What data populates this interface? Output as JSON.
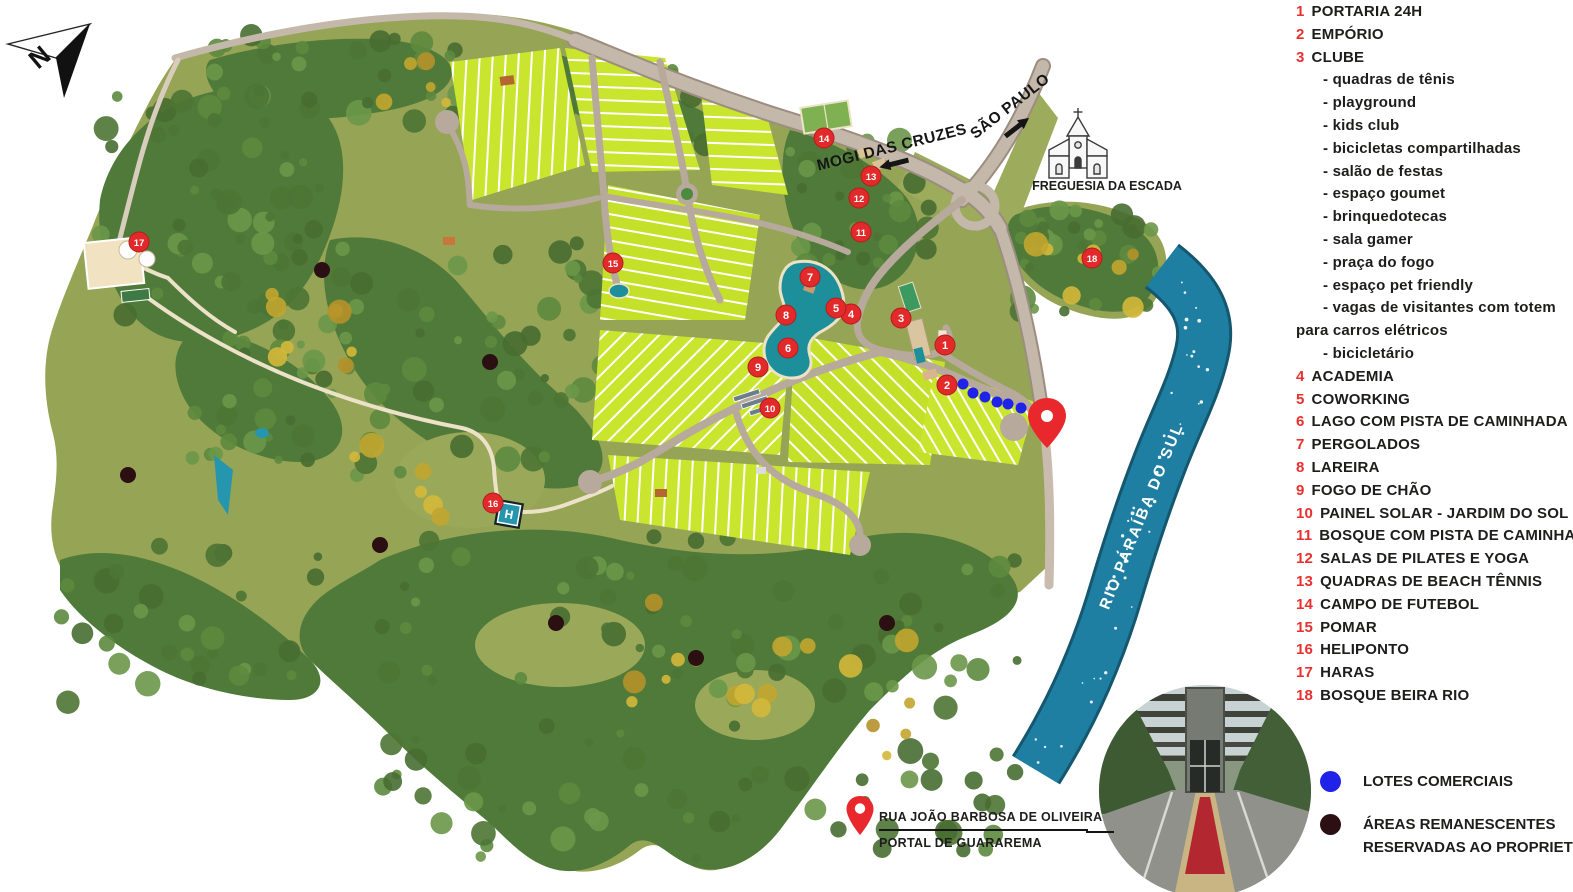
{
  "page": {
    "width": 1573,
    "height": 892,
    "background": "#ffffff"
  },
  "compass": {
    "label": "N"
  },
  "map_labels": {
    "road_west": "MOGI DAS CRUZES",
    "road_east": "SÃO PAULO",
    "church": "FREGUESIA DA ESCADA",
    "river": "RIO PARAÍBA DO SUL",
    "heliport_letter": "H"
  },
  "entrance_label": {
    "line1": "RUA JOÃO BARBOSA DE OLIVEIRA",
    "line2": "PORTAL DE GUARAREMA"
  },
  "legend": {
    "items": [
      {
        "num": "1",
        "label": "PORTARIA 24H"
      },
      {
        "num": "2",
        "label": "EMPÓRIO"
      },
      {
        "num": "3",
        "label": "CLUBE",
        "sub": [
          {
            "text": "quadras de tênis",
            "dash": true
          },
          {
            "text": "playground",
            "dash": true
          },
          {
            "text": "kids club",
            "dash": true
          },
          {
            "text": "bicicletas compartilhadas",
            "dash": true
          },
          {
            "text": "salão de festas",
            "dash": true
          },
          {
            "text": "espaço goumet",
            "dash": true
          },
          {
            "text": "brinquedotecas",
            "dash": true
          },
          {
            "text": "sala gamer",
            "dash": true
          },
          {
            "text": "praça do fogo",
            "dash": true
          },
          {
            "text": "espaço pet friendly",
            "dash": true
          },
          {
            "text": "vagas de visitantes com totem",
            "dash": true
          },
          {
            "text": "para carros elétricos",
            "dash": false
          },
          {
            "text": "bicicletário",
            "dash": true
          }
        ]
      },
      {
        "num": "4",
        "label": "ACADEMIA"
      },
      {
        "num": "5",
        "label": "COWORKING"
      },
      {
        "num": "6",
        "label": "LAGO COM PISTA DE CAMINHADA"
      },
      {
        "num": "7",
        "label": "PERGOLADOS"
      },
      {
        "num": "8",
        "label": "LAREIRA"
      },
      {
        "num": "9",
        "label": "FOGO DE CHÃO"
      },
      {
        "num": "10",
        "label": "PAINEL SOLAR - JARDIM DO SOL"
      },
      {
        "num": "11",
        "label": "BOSQUE COM PISTA DE CAMINHADA"
      },
      {
        "num": "12",
        "label": "SALAS DE PILATES E YOGA"
      },
      {
        "num": "13",
        "label": "QUADRAS DE BEACH TÊNNIS"
      },
      {
        "num": "14",
        "label": "CAMPO DE FUTEBOL"
      },
      {
        "num": "15",
        "label": "POMAR"
      },
      {
        "num": "16",
        "label": "HELIPONTO"
      },
      {
        "num": "17",
        "label": "HARAS"
      },
      {
        "num": "18",
        "label": "BOSQUE BEIRA RIO"
      }
    ]
  },
  "footer_legend": {
    "items": [
      {
        "name": "commercial-lots",
        "color": "#1f23ea",
        "label_lines": [
          "LOTES COMERCIAIS"
        ]
      },
      {
        "name": "owner-reserved-areas",
        "color": "#2c0f12",
        "label_lines": [
          "ÁREAS REMANESCENTES",
          "RESERVADAS AO PROPRIETÁRIO"
        ]
      }
    ]
  },
  "markers": [
    {
      "n": "1",
      "x": 945,
      "y": 345
    },
    {
      "n": "2",
      "x": 947,
      "y": 385
    },
    {
      "n": "3",
      "x": 901,
      "y": 318
    },
    {
      "n": "4",
      "x": 851,
      "y": 314
    },
    {
      "n": "5",
      "x": 836,
      "y": 308
    },
    {
      "n": "6",
      "x": 788,
      "y": 348
    },
    {
      "n": "7",
      "x": 810,
      "y": 277
    },
    {
      "n": "8",
      "x": 786,
      "y": 315
    },
    {
      "n": "9",
      "x": 758,
      "y": 367
    },
    {
      "n": "10",
      "x": 770,
      "y": 408
    },
    {
      "n": "11",
      "x": 861,
      "y": 232
    },
    {
      "n": "12",
      "x": 859,
      "y": 198
    },
    {
      "n": "13",
      "x": 871,
      "y": 176
    },
    {
      "n": "14",
      "x": 824,
      "y": 138
    },
    {
      "n": "15",
      "x": 613,
      "y": 263
    },
    {
      "n": "16",
      "x": 493,
      "y": 503
    },
    {
      "n": "17",
      "x": 139,
      "y": 242
    },
    {
      "n": "18",
      "x": 1092,
      "y": 258
    }
  ],
  "commercial_dots": [
    [
      963,
      384
    ],
    [
      973,
      393
    ],
    [
      985,
      397
    ],
    [
      997,
      402
    ],
    [
      1008,
      404
    ],
    [
      1021,
      408
    ]
  ],
  "owner_dots": [
    [
      322,
      270
    ],
    [
      490,
      362
    ],
    [
      128,
      475
    ],
    [
      380,
      545
    ],
    [
      556,
      623
    ],
    [
      696,
      658
    ],
    [
      887,
      623
    ]
  ],
  "colors": {
    "legend_red": "#e8302f",
    "marker_red": "#e22a2a",
    "pin_red": "#e8282c",
    "terrain": "#96a456",
    "forest": "#507a39",
    "lots": "#c9e52d",
    "road": "#b7a99c",
    "river": "#1e7fa2",
    "pool": "#1d8f9b",
    "commercial_dot": "#1f23ea",
    "owner_dot": "#2c0f12",
    "text": "#1d1d1b"
  }
}
